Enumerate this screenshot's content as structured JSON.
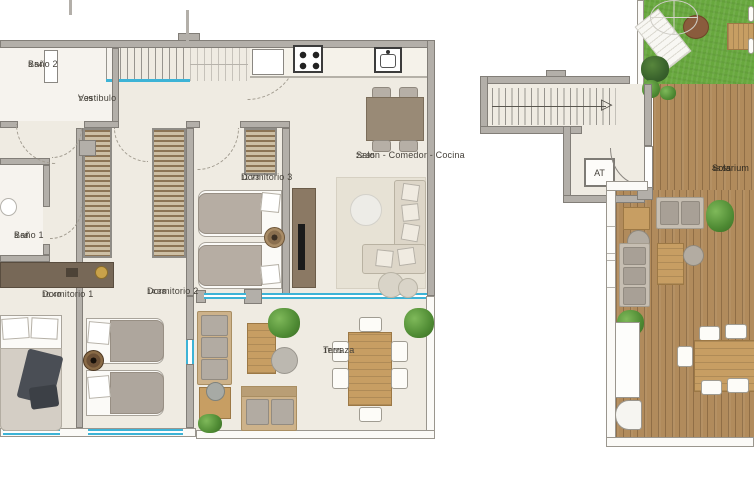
{
  "unit": {
    "rooms": {
      "bano2": {
        "name": "Baño 2",
        "area": "3.54"
      },
      "vestibulo": {
        "name": "Vestibulo",
        "area": "7.39"
      },
      "bano1": {
        "name": "Baño 1",
        "area": "3.68"
      },
      "dormitorio1": {
        "name": "Dormitorio 1",
        "area": "16.40"
      },
      "dormitorio2": {
        "name": "Dormitorio 2",
        "area": "14.38"
      },
      "dormitorio3": {
        "name": "Dormitorio 3",
        "area": "11.73"
      },
      "salon": {
        "name": "Salon - Comedor - Cocina",
        "area": "22.95"
      },
      "terraza": {
        "name": "Terraza",
        "area": "17.55"
      },
      "solarium": {
        "name": "Solarium",
        "area": "48.55"
      }
    },
    "elevator": {
      "label": "AT"
    }
  },
  "icons": {
    "stair_arrow": "▷"
  },
  "colors": {
    "wall": "#b3afa9",
    "wall_outline": "#827e78",
    "floor": "#efebe2",
    "bath_floor": "#f6f3ee",
    "glazing_blue": "#3db3d6",
    "deck_wood": "#b18b5c",
    "grass_green": "#68a83e",
    "furniture_wood": "#c79e63",
    "dark_cabinet": "#8b7964",
    "label_text": "#45413a"
  }
}
